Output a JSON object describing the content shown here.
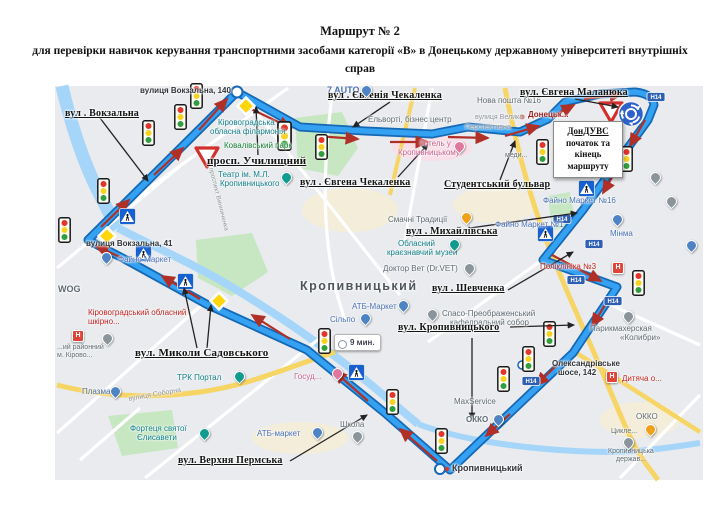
{
  "title": {
    "line1": "Маршрут № 2",
    "line2": "для перевірки навичок керування транспортними засобами категорії «В» в Донецькому державному університеті внутрішніх справ"
  },
  "route_box": {
    "line1": "ДонДУВС",
    "line2": "початок та",
    "line3": "кінець",
    "line4": "маршруту"
  },
  "time_bubble": "9 мин.",
  "road_badge": "Н14",
  "icons": {
    "hospital": "H"
  },
  "colors": {
    "route_blue": "#34a1f2",
    "route_casing": "#1468b4",
    "direction_red": "#b03028",
    "priority_yellow": "#ffd60a",
    "sign_blue": "#1660d0"
  },
  "annotations": {
    "vokzalna": "вул . Вокзальна",
    "uchylyshchnyi": "просп. Училищний",
    "chekalenka_top": "вул . Євгенія Чекаленка",
    "chekalenka_mid": "вул . Євгена Чекаленка",
    "malaniuka": "вул. Євгена Маланюка",
    "studentskyi": "Студентський бульвар",
    "mykhailivska": "вул . Михайлівська",
    "shevchenka": "вул . Шевченка",
    "kropyvnytskoho": "вул. Кропивницького",
    "sadovskoho": "вул. Миколи Садовського",
    "verkhnia_permska": "вул. Верхня Пермська"
  },
  "poi": {
    "vokzalna_140": "вулиця Вокзальна, 140",
    "seven_auto": "7 AUTO",
    "nova_poshta": "Нова пошта №16",
    "elvorti": "Ельворті, бізнес центр",
    "filarmonia1": "Кіровоградська",
    "filarmonia2": "обласна філармонія",
    "kovalivskyi_park": "Ковалівський парк",
    "teatr1": "Театр ім. М.Л.",
    "teatr2": "Кропивницького",
    "hotel1": "Готель у",
    "hotel2": "Кропивницькому",
    "perspektyvna1": "вулиця Велика",
    "perspektyvna2": "Перспективна",
    "donetsk": "Донецьк...",
    "medy": "меди...",
    "smachni": "Смачні Традиції",
    "faino16": "Файно Маркет №16",
    "faino1": "Файно Маркет №1",
    "minma": "Мінма",
    "muzei1": "Обласний",
    "muzei2": "краєзнавчий музей",
    "doktor_vet": "Доктор Вет (Dr.VET)",
    "city": "Кропивницький",
    "atb_mid": "АТБ-Маркет",
    "silpo": "Сільпо",
    "sobor1": "Спасо-Преображенський",
    "sobor2": "кафедральний собор",
    "kolibri1": "Парикмахерская",
    "kolibri2": "«Колибри»",
    "poliklinika": "Поліклініка №3",
    "wog": "WOG",
    "shkirno1": "Кіровоградський обласний",
    "shkirno2": "шкірно...",
    "raionnyi1": "...ий районний",
    "raionnyi2": "м. Кірово...",
    "plazma": "Плазма",
    "trk_portal": "ТРК Портал",
    "soborna": "вулиця Соборна",
    "vynnychenka": "проспект Винниченка",
    "fortecia1": "Фортеця святої",
    "fortecia2": "Єлисавети",
    "atb_bottom": "АТБ-маркет",
    "shkola": "Школа",
    "gosud": "Госуд...",
    "maxservice": "MaxService",
    "okko_left": "ОККО",
    "oleks1": "Олександрівське",
    "oleks2": "шосе, 142",
    "dytiacha": "Дитяча о...",
    "okko_right": "ОККО",
    "tsykl": "Цикле...",
    "krop1": "Кропивницька",
    "krop2": "держав...",
    "krop_bottom": "Кропивницький",
    "vokzalna_41": "вулиця Вокзальна, 41",
    "faino_left": "Файно Маркет"
  }
}
